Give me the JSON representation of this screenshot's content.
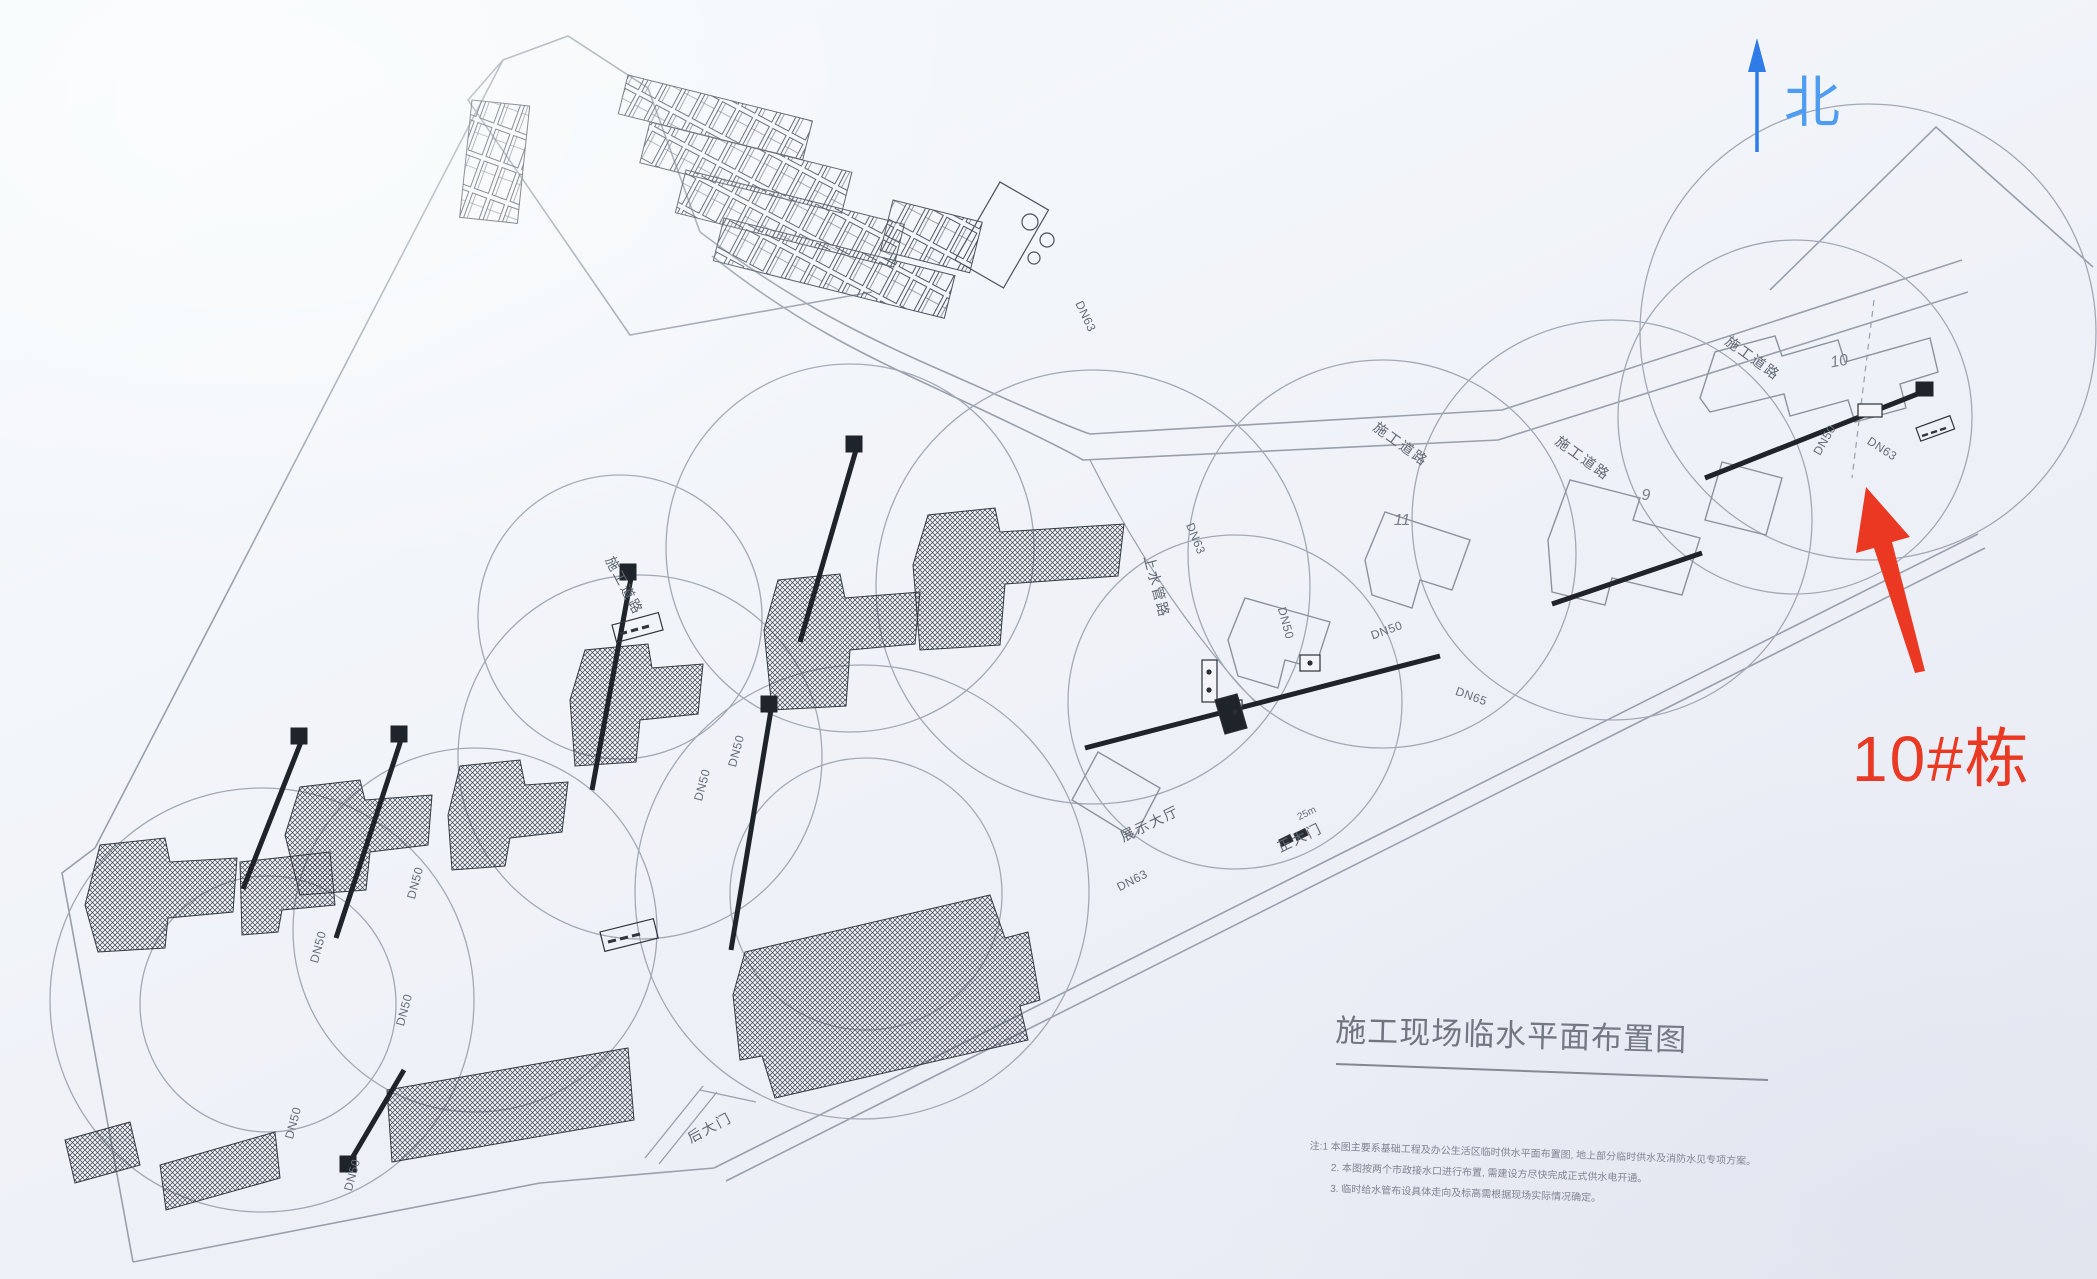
{
  "compass": {
    "label": "北"
  },
  "callout": {
    "label": "10#栋"
  },
  "title": {
    "text": "施工现场临水平面布置图"
  },
  "notes": {
    "line1": "注:1 本图主要系基础工程及办公生活区临时供水平面布置图, 地上部分临时供水及消防水见专项方案。",
    "line2": "2. 本图按两个市政接水口进行布置, 需建设方尽快完成正式供水电开通。",
    "line3": "3. 临时给水管布设具体走向及标高需根据现场实际情况确定。"
  },
  "labels": {
    "road": "施工道路",
    "water_main": "上水管路",
    "exhibition_hall": "展示大厅",
    "main_gate": "正大门",
    "rear_gate": "后大门",
    "distance": "25m",
    "dn50": "DN50",
    "dn63": "DN63",
    "dn65": "DN65",
    "b9": "9",
    "b10": "10",
    "b11": "11"
  },
  "colors": {
    "north": "#2e7ce8",
    "callout": "#ea3822",
    "ink": "#666d78"
  }
}
